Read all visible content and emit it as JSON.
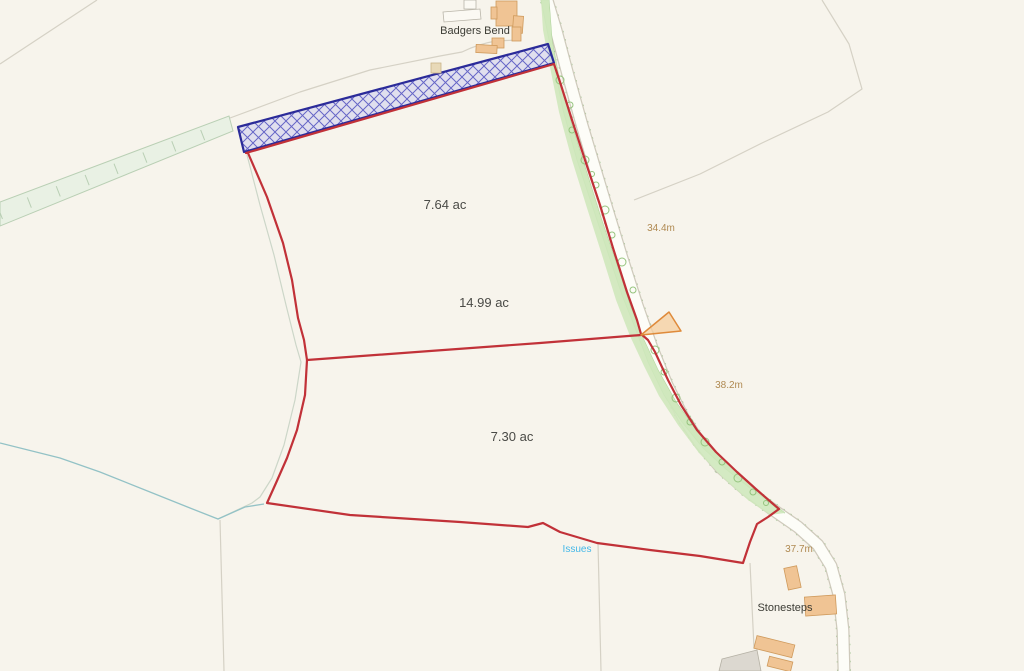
{
  "map": {
    "background_color": "#f7f4ec",
    "place_labels": {
      "badgers_bend": "Badgers Bend",
      "stonesteps": "Stonesteps"
    },
    "parcels": [
      {
        "label": "7.64 ac"
      },
      {
        "label": "14.99 ac"
      },
      {
        "label": "7.30 ac"
      }
    ],
    "elevation_markers": [
      {
        "label": "34.4m"
      },
      {
        "label": "38.2m"
      },
      {
        "label": "37.7m"
      }
    ],
    "water_label": "Issues",
    "colors": {
      "parcel_boundary_red": "#c13138",
      "hatched_strip_border_blue": "#2b2b99",
      "hatched_strip_fill": "#cdcdf0",
      "tree_strip_green": "#cfe8bd",
      "access_marker_orange": "#df8a3a",
      "building_fill": "#f0c494",
      "road_fill": "#fdfdf8",
      "elevation_text": "#b08a52",
      "water_text": "#45b8e8",
      "field_line_gray": "#d5d1c5"
    }
  }
}
